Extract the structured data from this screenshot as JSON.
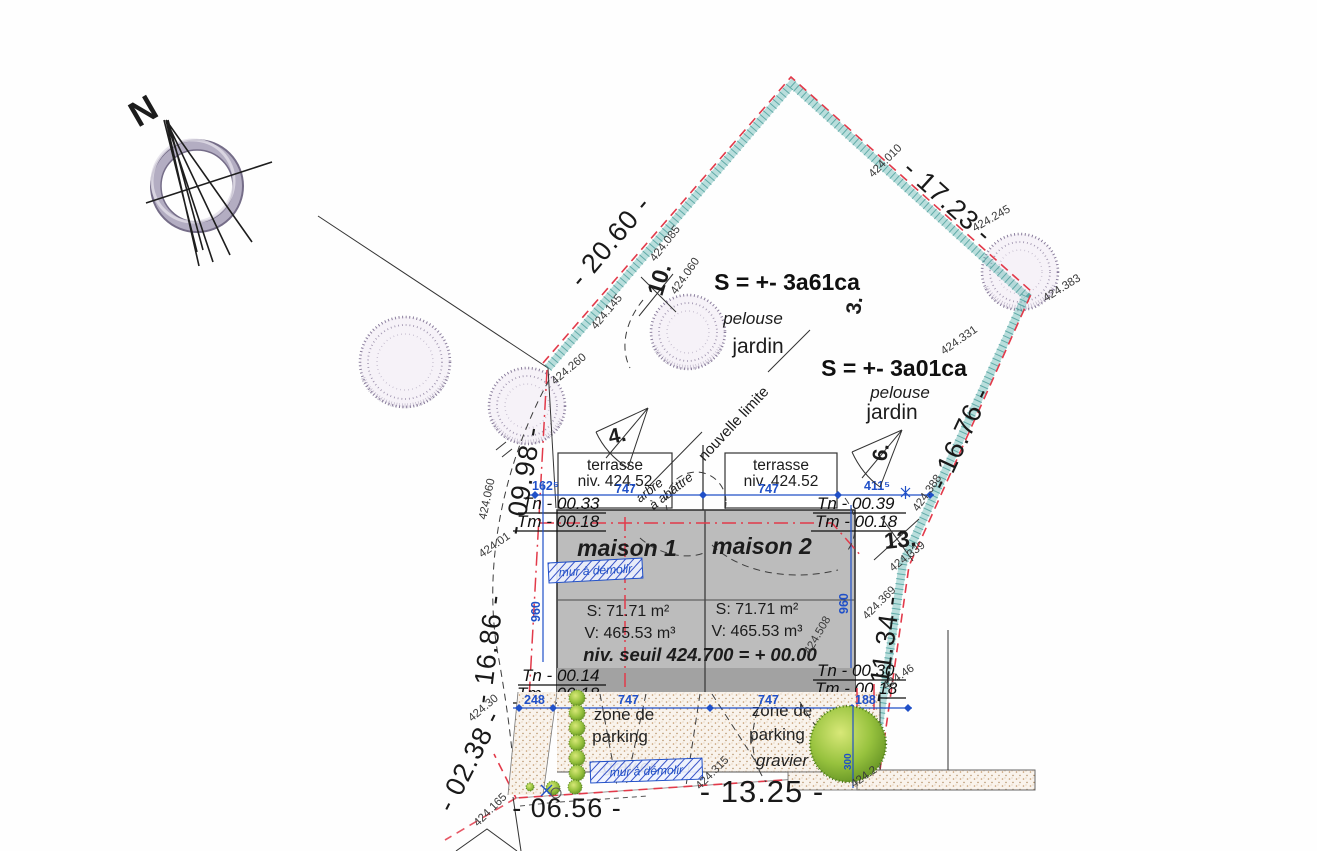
{
  "colors": {
    "boundary_teal": "#66b8b4",
    "boundary_red": "#e23a4a",
    "measure_blue": "#2050c8",
    "house_gray": "#bcbcbc",
    "wall_dark_gray": "#a2a2a2",
    "tree_green": "#8fbe3a",
    "gravel_bg": "#f9f2ea",
    "gravel_dot": "#c09a6a",
    "scribble_tree": "#8a7d9c",
    "paper": "#fefefe"
  },
  "compass": {
    "north": "N"
  },
  "parcel_left": {
    "area": "S = +- 3a61ca",
    "ground": "pelouse",
    "label": "jardin"
  },
  "parcel_right": {
    "area": "S = +- 3a01ca",
    "ground": "pelouse",
    "label": "jardin"
  },
  "new_limit": "nouvelle limite",
  "dimensions": {
    "top_left": "- 20.60 -",
    "top_right": "- 17.23 -",
    "right_upper": "- 16.76 -",
    "right_lower": "- 11.34 -",
    "left_upper": "- 09.98 -",
    "left_lower": "- 16.86 -",
    "bottom_short": "- 02.38 -",
    "bottom_left": "- 06.56 -",
    "bottom_main": "- 13.25 -"
  },
  "blue_top": [
    "162⁵",
    "747",
    "747",
    "411⁵"
  ],
  "blue_bottom": [
    "248",
    "747",
    "747",
    "188"
  ],
  "blue_vertical": {
    "left": "960",
    "right": "960",
    "tree": "300"
  },
  "terrace_left": {
    "name": "terrasse",
    "level": "niv. 424.52"
  },
  "terrace_right": {
    "name": "terrasse",
    "level": "niv. 424.52"
  },
  "house1": {
    "name": "maison 1",
    "surface": "S: 71.71 m²",
    "volume": "V: 465.53 m³"
  },
  "house2": {
    "name": "maison 2",
    "surface": "S: 71.71 m²",
    "volume": "V: 465.53 m³"
  },
  "threshold": "niv. seuil 424.700 = + 00.00",
  "levels": {
    "top_left_tn": "Tn - 00.33",
    "top_left_tm": "Tm - 00.18",
    "top_right_tn": "Tn - 00.39",
    "top_right_tm": "Tm - 00.18",
    "bottom_left_tn": "Tn - 00.14",
    "bottom_left_tm": "Tm - 00.18",
    "bottom_right_tn": "Tn - 00.30",
    "bottom_right_tm": "Tm - 00.18"
  },
  "parking_left": {
    "l1": "zone de",
    "l2": "parking",
    "l3": "gravier"
  },
  "parking_right": {
    "l1": "zone de",
    "l2": "parking",
    "l3": "gravier"
  },
  "demolish": {
    "wall1": "mur à démolir",
    "wall2": "mur à démolir",
    "tree1": "arbre",
    "tree2": "à abattre"
  },
  "markers": {
    "m10": "10.",
    "m3": "3.",
    "m4": "4.",
    "m6": "6.",
    "m13": "13."
  },
  "spots": {
    "top_apex": "424.010",
    "top_right_outer": "424.245",
    "right_tree": "424.383",
    "right_upper": "424.331",
    "upper_mid_1": "424.085",
    "upper_mid_2": "424.060",
    "left_upper": "424.145",
    "left_corner": "424.260",
    "left_edge": "424.060",
    "left_mid": "424.01",
    "left_lower": "424.30",
    "right_388": "424.388",
    "right_339": "424.339",
    "right_369": "424.369",
    "inner_508": "424.508",
    "right_46": "424.46",
    "parking_315": "424.315",
    "bottom_left_165": "424.165",
    "bottom_right": "424.2"
  }
}
